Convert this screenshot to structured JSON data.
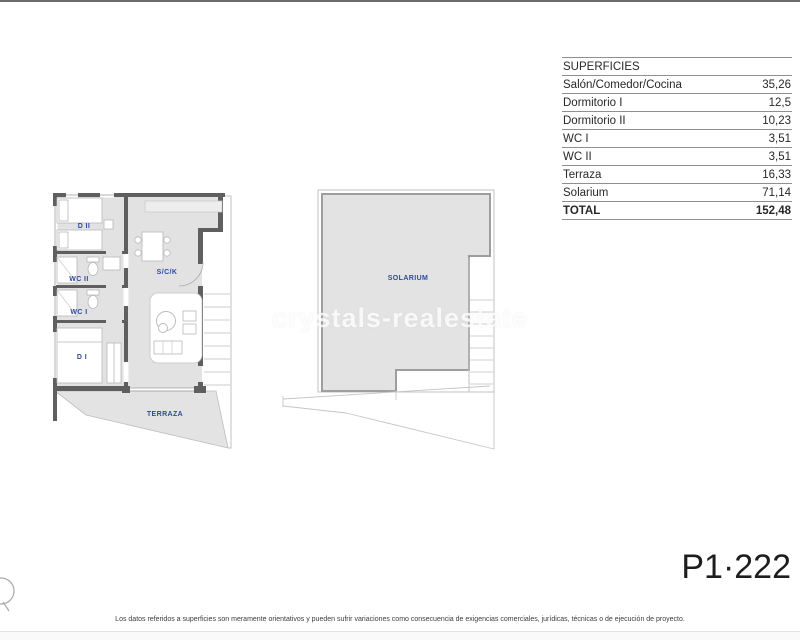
{
  "page": {
    "watermark": "crystals-realestate",
    "plan_code": "P1·222",
    "disclaimer": "Los datos referidos a superficies son meramente orientativos y pueden sufrir variaciones como consecuencia de exigencias comerciales, jurídicas, técnicas o de ejecución de proyecto."
  },
  "table": {
    "header": "SUPERFICIES",
    "rows": [
      {
        "label": "Salón/Comedor/Cocina",
        "value": "35,26"
      },
      {
        "label": "Dormitorio I",
        "value": "12,5"
      },
      {
        "label": "Dormitorio II",
        "value": "10,23"
      },
      {
        "label": "WC I",
        "value": "3,51"
      },
      {
        "label": "WC II",
        "value": "3,51"
      },
      {
        "label": "Terraza",
        "value": "16,33"
      },
      {
        "label": "Solarium",
        "value": "71,14"
      }
    ],
    "total": {
      "label": "TOTAL",
      "value": "152,48"
    }
  },
  "floor_plan": {
    "rooms": {
      "dormitorio2": "D II",
      "wc2": "WC II",
      "wc1": "WC I",
      "dormitorio1": "D I",
      "salon": "S/C/K",
      "terraza": "TERRAZA"
    }
  },
  "solarium_plan": {
    "label": "SOLARIUM"
  },
  "colors": {
    "accent_blue": "#2e4a9e",
    "wall_gray": "#5f5f5f",
    "room_fill": "#e2e2e2"
  }
}
